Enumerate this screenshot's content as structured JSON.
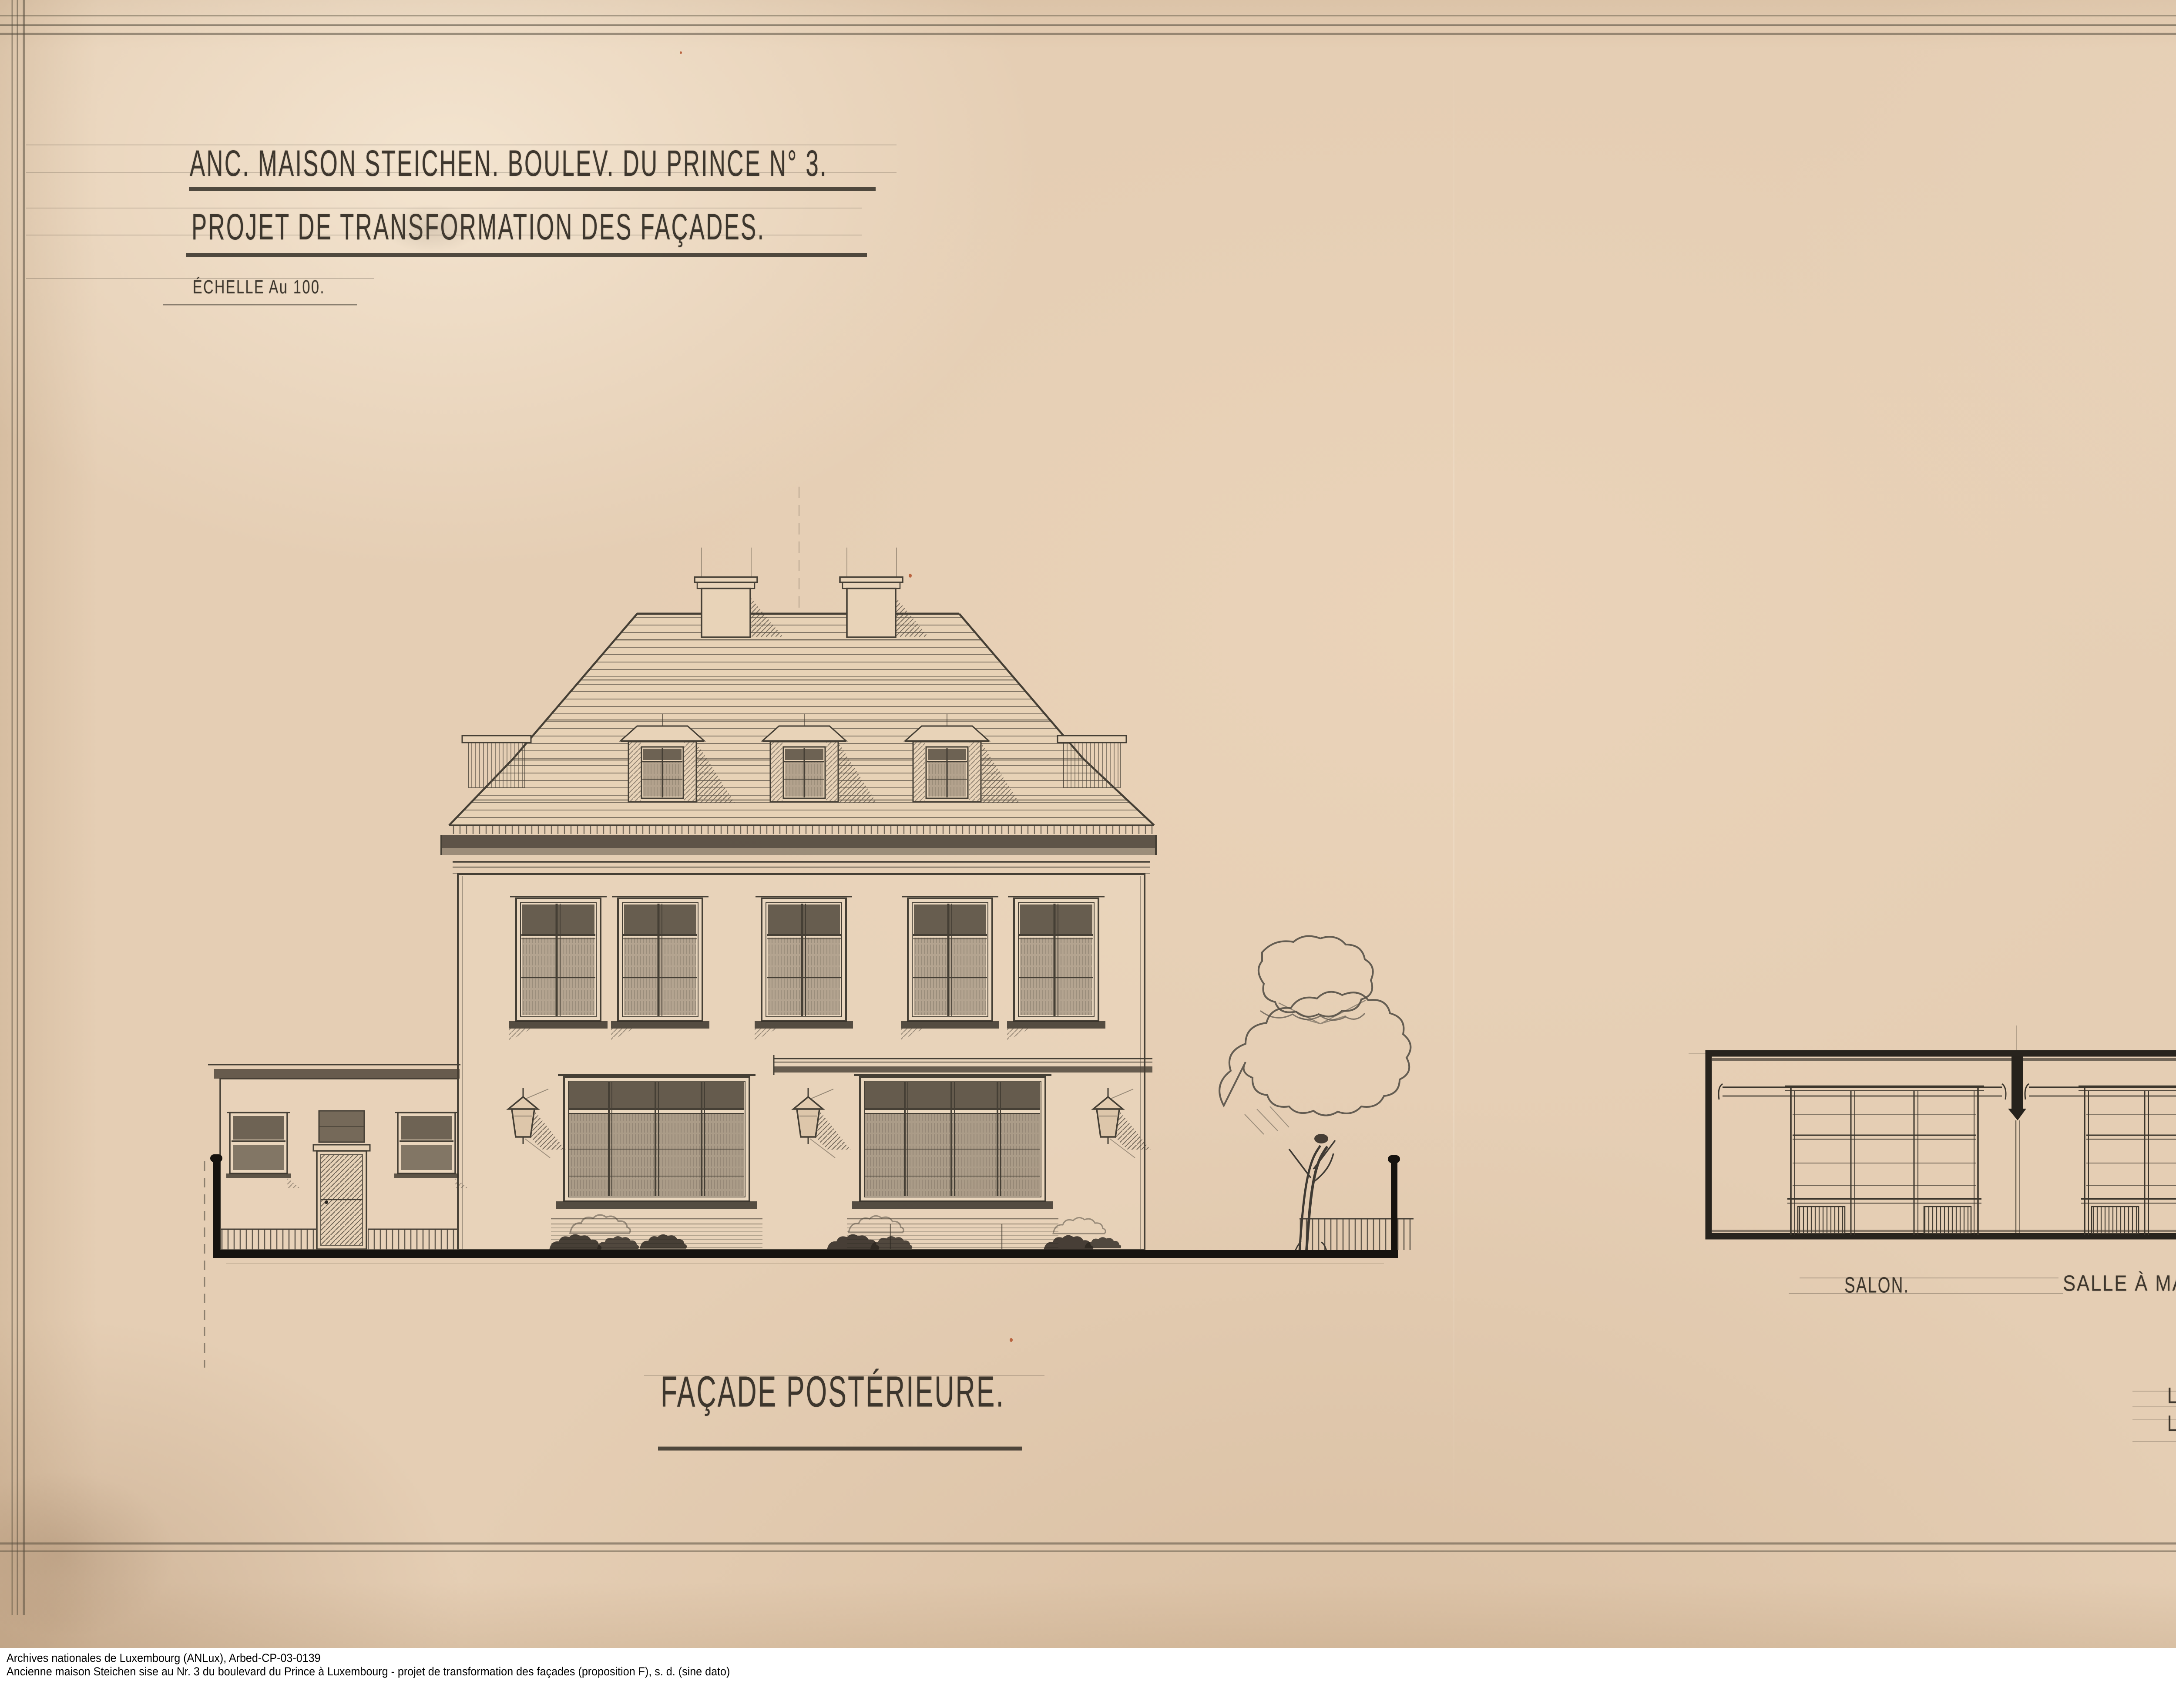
{
  "document": {
    "title_line1": "ANC. MAISON STEICHEN. BOULEV. DU PRINCE N° 3.",
    "title_line2": "PROJET DE TRANSFORMATION DES FAÇADES.",
    "scale_note": "ÉCHELLE Au 100.",
    "proposal_label": "PROPOS.",
    "proposal_letter": "F.",
    "drawing_caption": "FAÇADE POSTÉRIEURE.",
    "room_labels": {
      "salon": "SALON.",
      "dining": "SALLE À MANGER."
    },
    "signature_line1": "LUXEMBOURG. LE",
    "signature_line2": "L'ARCHITECTE EN CHEF D'ARBED„",
    "inventory_number_script": "88",
    "inventory_number_stamp": "4996"
  },
  "caption_bar": {
    "line1": "Archives nationales de Luxembourg (ANLux), Arbed-CP-03-0139",
    "line2": "Ancienne maison Steichen sise au Nr. 3 du boulevard du Prince à Luxembourg - projet de transformation des façades (proposition F), s. d. (sine dato)",
    "license_badge": {
      "cc_text": "cc",
      "nc_glyph": "€",
      "by": "BY",
      "nc": "NC",
      "nd": "ND"
    }
  },
  "colors": {
    "paper": "#e5ceb4",
    "pencil": "#4a4339",
    "heavy_ink": "#16130f",
    "caption_background": "#ffffff",
    "badge_gray": "#aab2a9"
  }
}
